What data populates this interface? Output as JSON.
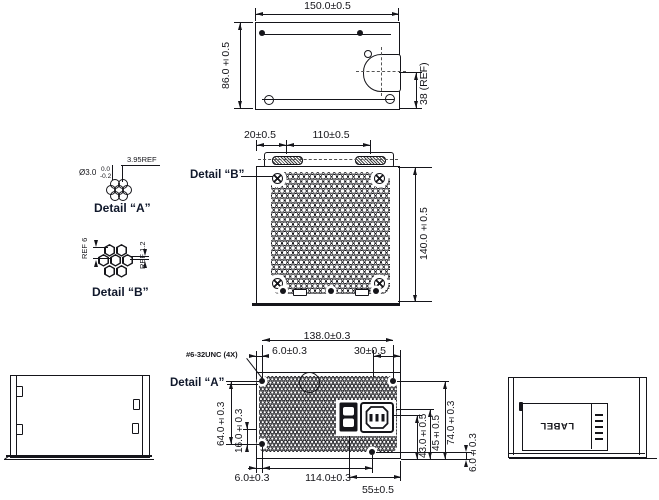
{
  "rear": {
    "dim_width": "150.0±0.5",
    "dim_height": "86.0±0.5",
    "dim_ref": "38 (REF)"
  },
  "top": {
    "dim_offset": "20±0.5",
    "dim_pitch": "110±0.5",
    "dim_depth": "140.0±0.5",
    "detail_b_callout": "Detail “B”"
  },
  "detail_a": {
    "title": "Detail “A”",
    "pitch": "3.95REF",
    "dia": "Ø3.0",
    "tol_hi": "0.0",
    "tol_lo": "-0.2"
  },
  "detail_b": {
    "title": "Detail “B”",
    "ref_height": "REF 6",
    "ref_web": "REF 1.2"
  },
  "bottom": {
    "dim_width": "138.0±0.3",
    "dim_edge_top": "6.0±0.3",
    "dim_30": "30±0.5",
    "thread_note": "#6-32UNC (4X)",
    "detail_a_callout": "Detail “A”",
    "dim_64": "64.0±0.3",
    "dim_16": "16.0±0.3",
    "dim_edge_bot": "6.0±0.3",
    "dim_114": "114.0±0.3",
    "dim_55": "55±0.5",
    "dim_43": "43.0±0.5",
    "dim_45": "45±0.5",
    "dim_74": "74.0±0.3",
    "dim_6r": "6.0±0.3"
  },
  "side_right": {
    "label_text": "LABEL"
  }
}
